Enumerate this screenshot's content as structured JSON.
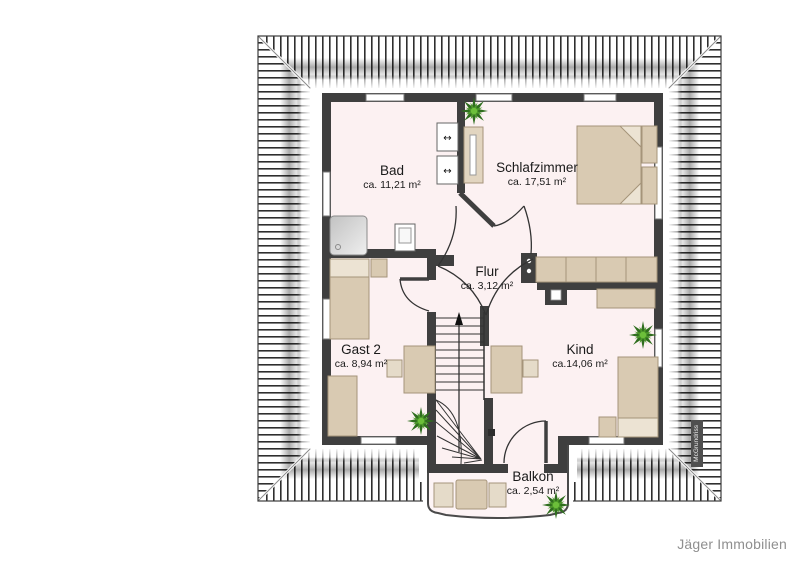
{
  "plan": {
    "title": "Obergeschoss Grundriss",
    "rooms": [
      {
        "name": "Bad",
        "area": "ca. 11,21 m²"
      },
      {
        "name": "Schlafzimmer",
        "area": "ca. 17,51 m²"
      },
      {
        "name": "Flur",
        "area": "ca. 3,12 m²"
      },
      {
        "name": "Gast 2",
        "area": "ca. 8,94 m²"
      },
      {
        "name": "Kind",
        "area": "ca.14,06 m²"
      },
      {
        "name": "Balkon",
        "area": "ca. 2,54 m²"
      }
    ],
    "stairs_direction": "up"
  },
  "branding": {
    "company": "Jäger Immobilien",
    "watermark": "McGrundriss"
  },
  "icons": {
    "plant": "plant-icon",
    "stairs_arrow": "up-arrow-icon",
    "washbasin_arrow": "left-right-arrow-icon"
  },
  "colors": {
    "wall": "#3f3f3f",
    "floor": "#fcf1f2",
    "roof_stripe": "#2f2f2f",
    "furniture": "#d9cab2",
    "furniture_light": "#ece3d3",
    "plant_green": "#4e9a2b",
    "label_text": "#1a1a1a",
    "company_text": "#8f8f8f"
  },
  "glyphs": {
    "basin_arrow": "↔"
  }
}
